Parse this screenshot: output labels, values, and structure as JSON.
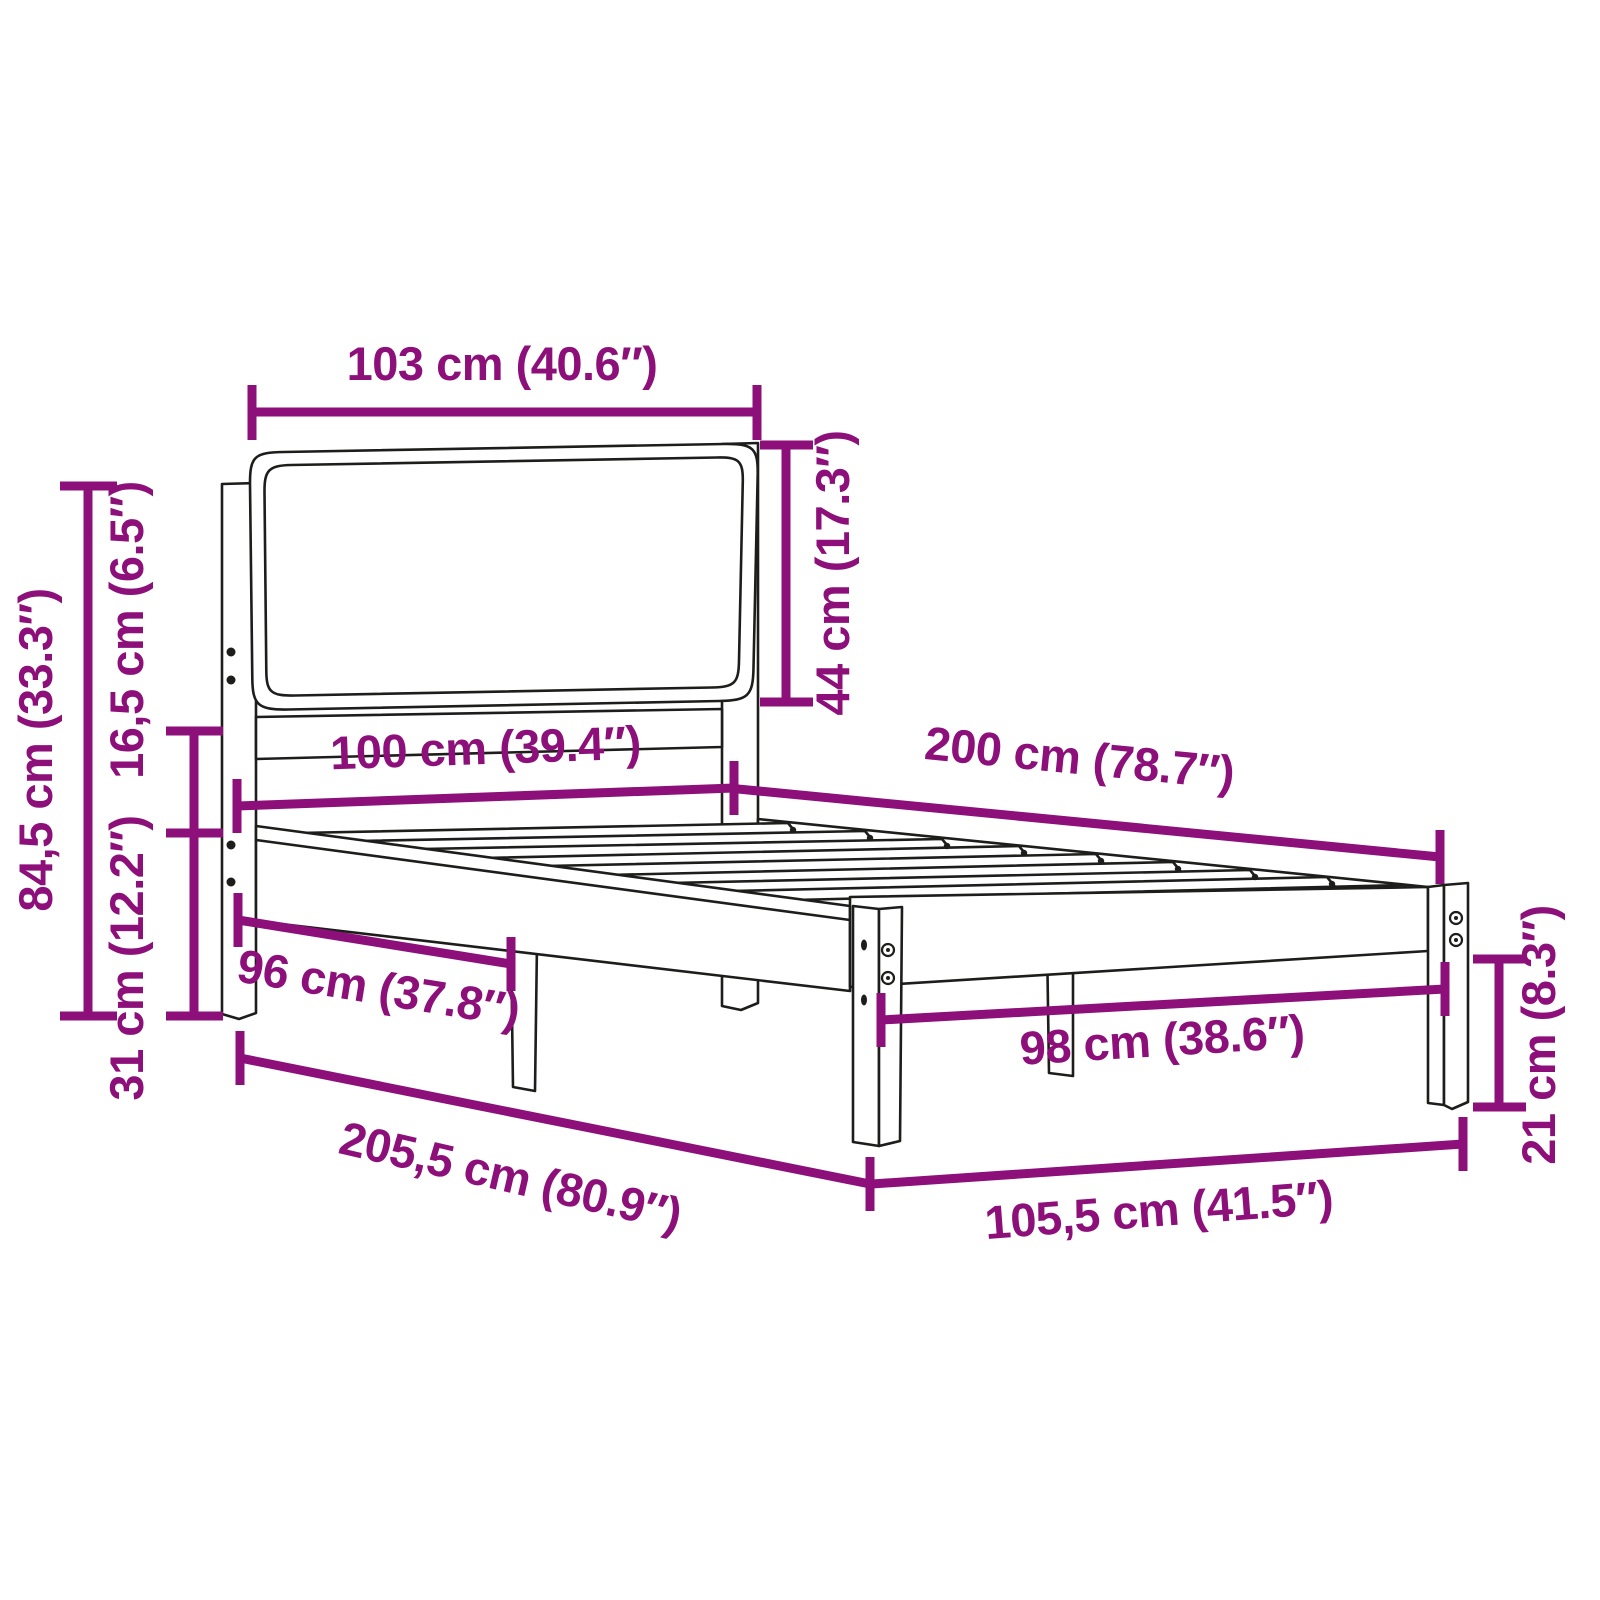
{
  "diagram": {
    "type": "product-dimension-diagram",
    "subject": "bed-frame-with-upholstered-headboard",
    "colors": {
      "accent": "#8C0F7A",
      "line": "#1D1D1B",
      "background": "#FFFFFF"
    },
    "dimensions": [
      {
        "id": "headboard-width",
        "label": "103 cm (40.6″)"
      },
      {
        "id": "headboard-height",
        "label": "44 cm (17.3″)"
      },
      {
        "id": "total-height",
        "label": "84,5 cm (33.3″)"
      },
      {
        "id": "frame-top-height",
        "label": "16,5 cm (6.5″)"
      },
      {
        "id": "clearance-height",
        "label": "31 cm (12.2″)"
      },
      {
        "id": "bed-width",
        "label": "100 cm (39.4″)"
      },
      {
        "id": "bed-length",
        "label": "200 cm (78.7″)"
      },
      {
        "id": "head-inner-width",
        "label": "96 cm (37.8″)"
      },
      {
        "id": "total-length",
        "label": "205,5 cm (80.9″)"
      },
      {
        "id": "foot-inner-width",
        "label": "98 cm (38.6″)"
      },
      {
        "id": "leg-height",
        "label": "21 cm (8.3″)"
      },
      {
        "id": "total-width",
        "label": "105,5 cm (41.5″)"
      }
    ]
  }
}
